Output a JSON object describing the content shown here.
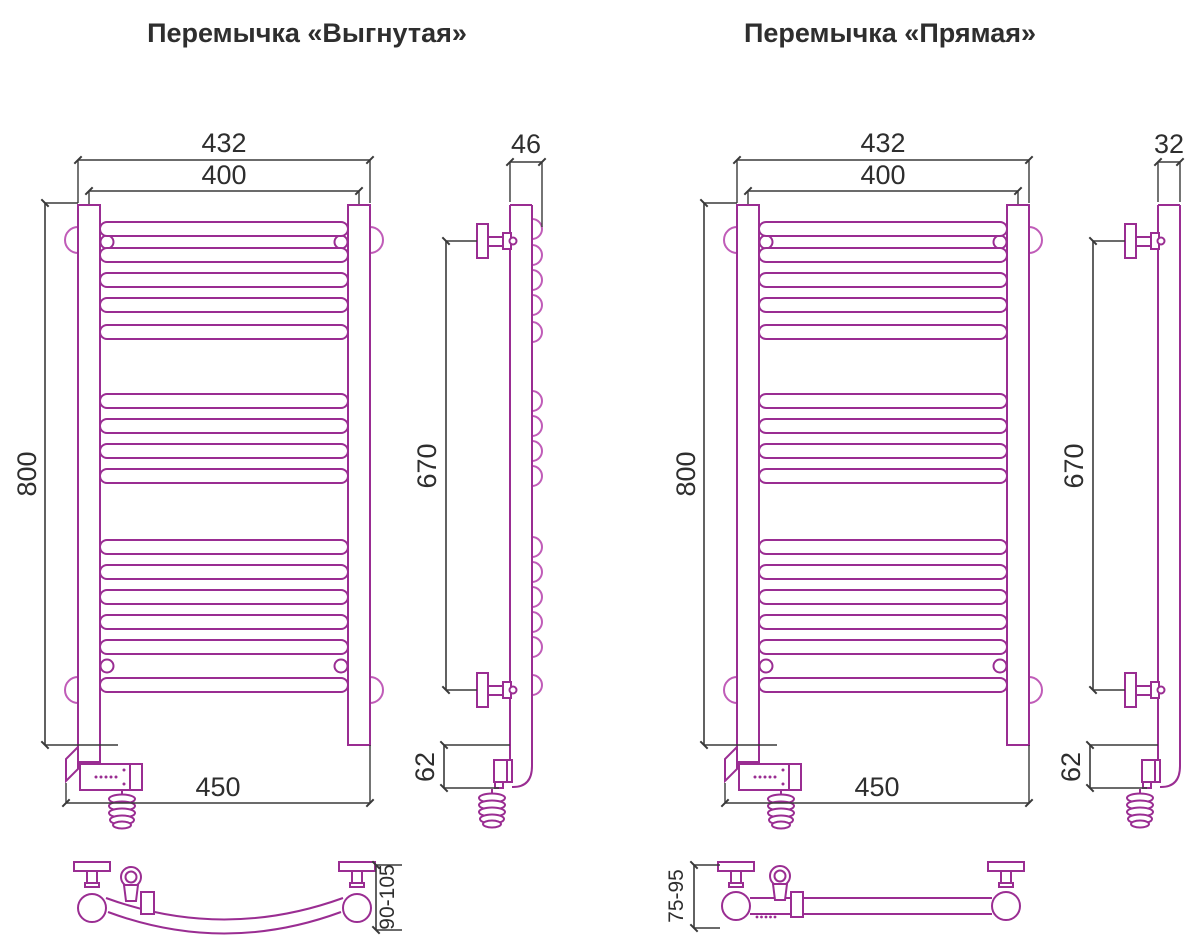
{
  "colors": {
    "magenta": "#9a2d92",
    "pink": "#c05cb8",
    "ink": "#3a3a3a"
  },
  "titles": {
    "left": "Перемычка «Выгнутая»",
    "right": "Перемычка «Прямая»"
  },
  "left": {
    "front": {
      "overall_width": "432",
      "axis_width": "400",
      "height": "800",
      "base_width": "450"
    },
    "side": {
      "depth": "46",
      "mount_span": "670",
      "bottom_offset": "62"
    },
    "top_view": {
      "wall_distance": "90-105"
    }
  },
  "right": {
    "front": {
      "overall_width": "432",
      "axis_width": "400",
      "height": "800",
      "base_width": "450"
    },
    "side": {
      "depth": "32",
      "mount_span": "670",
      "bottom_offset": "62"
    },
    "top_view": {
      "wall_distance": "75-95"
    }
  }
}
